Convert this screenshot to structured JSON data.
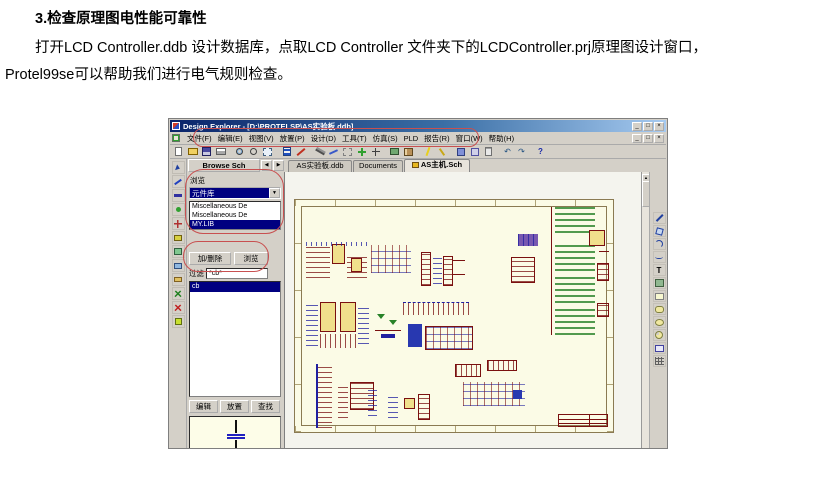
{
  "doc": {
    "heading": "3.检查原理图电性能可靠性",
    "line1": "打开LCD Controller.ddb 设计数据库，点取LCD Controller 文件夹下的LCDController.prj原理图设计窗口，",
    "line2": "Protel99se可以帮助我们进行电气规则检查。"
  },
  "app": {
    "title": "Design Explorer - [D:\\PROTELSP\\AS实验板.ddb]",
    "window_controls": {
      "minimize": "_",
      "restore": "□",
      "close": "×"
    },
    "menu": [
      "文件(F)",
      "编辑(E)",
      "视图(V)",
      "放置(P)",
      "设计(D)",
      "工具(T)",
      "仿真(S)",
      "PLD",
      "报告(R)",
      "窗口(W)",
      "帮助(H)"
    ],
    "icons": {
      "dropdown_arrow": "▼",
      "scroll_left": "◀",
      "scroll_right": "▶",
      "scroll_up": "▲",
      "scroll_down": "▼",
      "undo": "↶",
      "redo": "↷",
      "help": "?",
      "text_tool": "T",
      "line_tool": "/"
    },
    "panel_header": "Browse Sch",
    "tabs": [
      {
        "label": "AS实验板.ddb"
      },
      {
        "label": "Documents"
      },
      {
        "label": "AS主机.Sch"
      }
    ],
    "browse": {
      "label": "浏览",
      "dropdown_value": "元件库",
      "libraries": [
        "Miscellaneous De",
        "Miscellaneous De",
        "MY.LIB"
      ],
      "selected_library": "MY.LIB",
      "add_remove_button": "加/删除",
      "browse_button": "浏览",
      "filter_label": "过滤",
      "filter_value": "*cb*",
      "components": [
        "cb"
      ],
      "selected_component": "cb",
      "edit_button": "编辑",
      "place_button": "放置",
      "find_button": "查找"
    },
    "colors": {
      "titlebar_left": "#0a246a",
      "titlebar_right": "#a6caf0",
      "chrome": "#d4d0c8",
      "selection": "#000080",
      "sheet": "#fbfbe6",
      "annotation_red": "#c85050",
      "schematic_maroon": "#7a1010",
      "schematic_blue": "#2020a0",
      "schematic_green": "#288228",
      "ic_yellow": "#f0e08c"
    }
  }
}
